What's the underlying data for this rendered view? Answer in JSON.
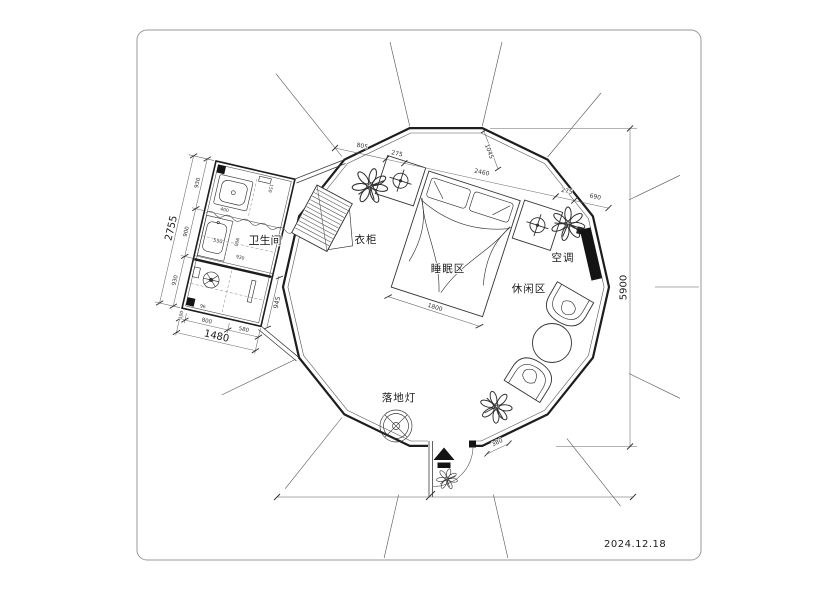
{
  "frame": {
    "date": "2024.12.18"
  },
  "rooms": {
    "bathroom": "卫生间",
    "wardrobe": "衣柜",
    "sleeping": "睡眠区",
    "leisure": "休闲区",
    "air_conditioner": "空调",
    "floor_lamp": "落地灯"
  },
  "dims": {
    "overall_height": "5900",
    "wall_chain": [
      "805",
      "275",
      "2460",
      "275",
      "690"
    ],
    "ridge_offset": "1045",
    "bed_width": "1800",
    "entrance_step": "380",
    "bath_passage": "945",
    "bath_height_total": "2755",
    "bath_height_chain": [
      "930",
      "900",
      "930"
    ],
    "bath_width_total": "1480",
    "bath_width_chain": [
      "100",
      "800",
      "580"
    ],
    "bath_sink": "550",
    "bath_inner": [
      "900",
      "930",
      "400",
      "150",
      "96"
    ]
  },
  "colors": {
    "wall": "#1d1d1d",
    "line": "#444444",
    "fill": "#141414",
    "frame": "#9a9a9a"
  }
}
